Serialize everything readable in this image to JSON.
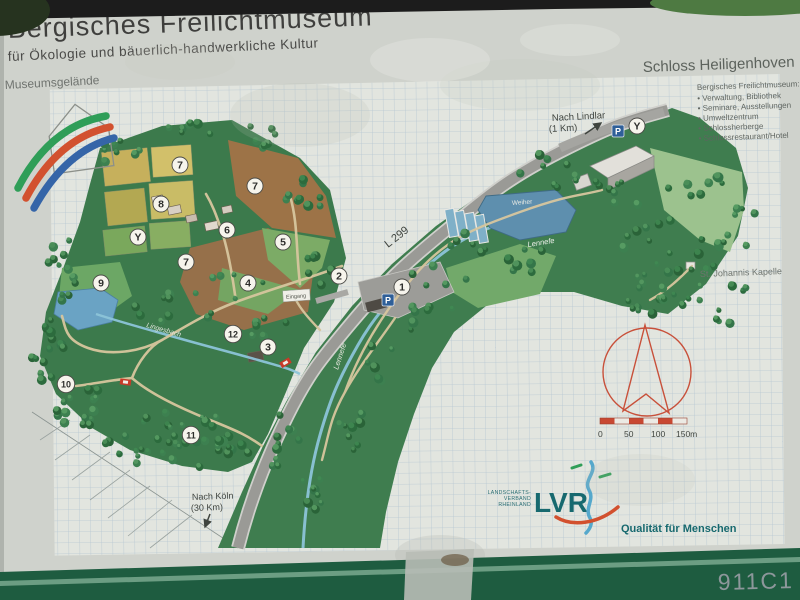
{
  "sign": {
    "title": "Bergisches Freilichtmuseum",
    "subtitle": "für Ökologie und bäuerlich-handwerkliche Kultur",
    "area_label": "Museumsgelände",
    "photo_code": "911C1"
  },
  "schloss": {
    "heading": "Schloss Heiligenhoven",
    "list_title": "Bergisches Freilichtmuseum:",
    "items": [
      "• Verwaltung, Bibliothek",
      "• Seminare, Ausstellungen",
      "• Umweltzentrum",
      "• Schlossherberge",
      "• Schlossrestaurant/Hotel"
    ]
  },
  "map": {
    "road_label": "L 299",
    "direction_lindlar": "Nach Lindlar",
    "direction_lindlar_dist": "(1 Km)",
    "direction_koeln": "Nach Köln",
    "direction_koeln_dist": "(30 Km)",
    "chapel_label": "St. Johannis Kapelle",
    "stream_label_left": "Lingesbach",
    "stream_label_right": "Lennefe",
    "stream_label_lower": "Lennefe",
    "pond_label": "Weiher",
    "entrance_label": "Eingang",
    "parking_label": "P",
    "scale_ticks": [
      "0",
      "50",
      "100",
      "150m"
    ],
    "markers": [
      {
        "label": "1",
        "x": 402,
        "y": 287
      },
      {
        "label": "2",
        "x": 339,
        "y": 276
      },
      {
        "label": "3",
        "x": 268,
        "y": 347
      },
      {
        "label": "4",
        "x": 248,
        "y": 283
      },
      {
        "label": "5",
        "x": 283,
        "y": 242
      },
      {
        "label": "6",
        "x": 227,
        "y": 230
      },
      {
        "label": "7",
        "x": 180,
        "y": 165
      },
      {
        "label": "7",
        "x": 255,
        "y": 186
      },
      {
        "label": "7",
        "x": 186,
        "y": 262
      },
      {
        "label": "8",
        "x": 161,
        "y": 204
      },
      {
        "label": "9",
        "x": 101,
        "y": 283
      },
      {
        "label": "10",
        "x": 66,
        "y": 384
      },
      {
        "label": "11",
        "x": 191,
        "y": 435
      },
      {
        "label": "12",
        "x": 233,
        "y": 334
      },
      {
        "label": "Y",
        "x": 138,
        "y": 237
      },
      {
        "label": "Y",
        "x": 637,
        "y": 126
      }
    ],
    "parking_badges": [
      {
        "x": 388,
        "y": 300
      },
      {
        "x": 618,
        "y": 131
      }
    ]
  },
  "lvr": {
    "org": [
      "LANDSCHAFTS-",
      "VERBAND",
      "RHEINLAND"
    ],
    "acronym": "LVR",
    "tagline": "Qualität für Menschen"
  },
  "colors": {
    "frame_green": "#1e5c40",
    "accent_red": "#c8503a",
    "lvr_teal": "#17696f",
    "water_blue": "#6aa3c4",
    "forest_green": "#2f6b3f"
  }
}
